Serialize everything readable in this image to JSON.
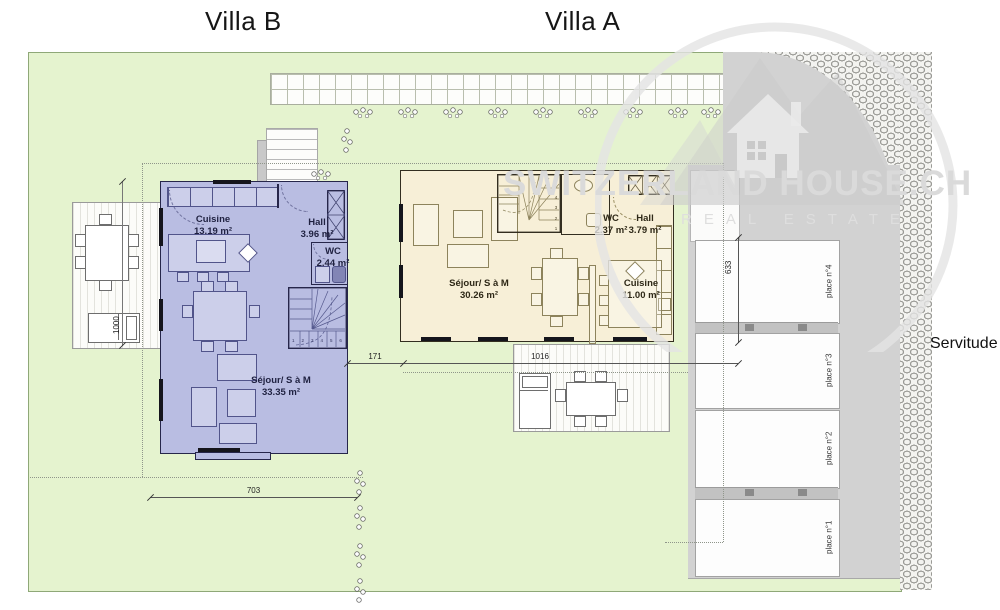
{
  "page": {
    "title_villa_b": "Villa B",
    "title_villa_a": "Villa A",
    "servitude": "Servitude"
  },
  "villa_b": {
    "rooms": {
      "cuisine": {
        "name": "Cuisine",
        "area": "13.19 m²"
      },
      "hall": {
        "name": "Hall",
        "area": "3.96 m²"
      },
      "wc": {
        "name": "WC",
        "area": "2.44 m²"
      },
      "sejour": {
        "name": "Séjour/ S à M",
        "area": "33.35 m²"
      }
    },
    "stair_numbers": [
      "1",
      "2",
      "3",
      "4",
      "5",
      "6"
    ]
  },
  "villa_a": {
    "rooms": {
      "sejour": {
        "name": "Séjour/ S à M",
        "area": "30.26 m²"
      },
      "wc": {
        "name": "WC",
        "area": "2.37 m²"
      },
      "hall": {
        "name": "Hall",
        "area": "3.79 m²"
      },
      "cuisine": {
        "name": "Cuisine",
        "area": "11.00 m²"
      }
    },
    "stair_numbers": [
      "1",
      "2",
      "3",
      "4"
    ]
  },
  "dimensions": {
    "terrace_b_depth": "1000",
    "villa_gap": "171",
    "front_width": "1016",
    "villa_b_width": "703",
    "parking_depth": "633"
  },
  "parking": {
    "place_4": "place n°4",
    "place_3": "place n°3",
    "place_2": "place n°2",
    "place_1": "place n°1"
  },
  "watermark": {
    "brand": "SWITZERLAND HOUSE.CH",
    "tagline": "REAL ESTATE"
  },
  "colors": {
    "lawn": "#e5f3cf",
    "villa_b_fill": "#b9bde2",
    "villa_a_fill": "#f7efd7",
    "driveway": "#d2d2d2",
    "watermark_gray": "#d9d9d9"
  }
}
